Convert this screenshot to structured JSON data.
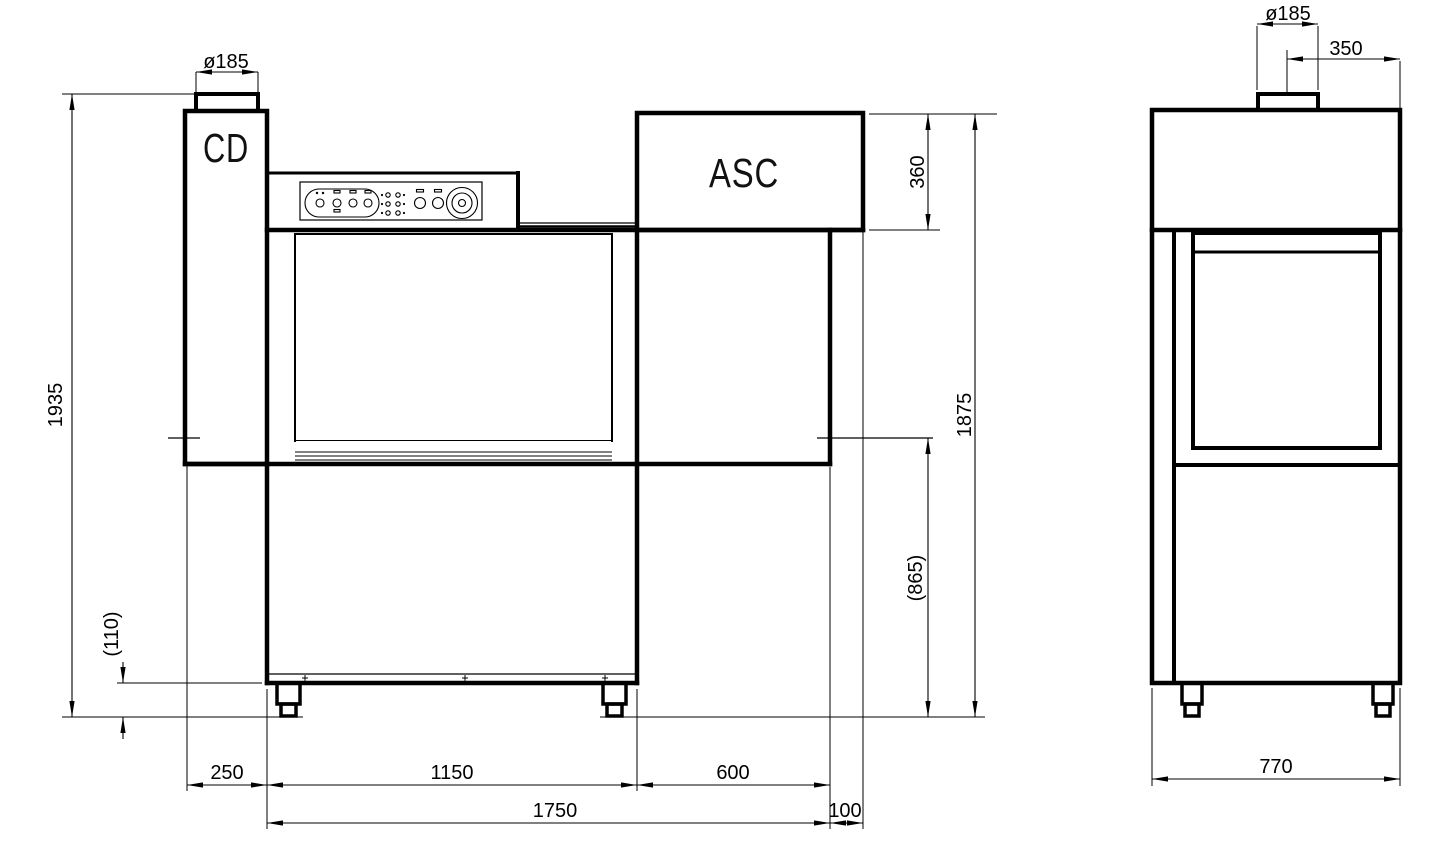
{
  "drawing": {
    "type": "technical-drawing",
    "units": {
      "cd_label": "CD",
      "asc_label": "ASC"
    },
    "front_view": {
      "dim_flue_diameter": "ø185",
      "dim_total_height": "1935",
      "dim_plinth_height": "(110)",
      "dim_hood_section_height": "360",
      "dim_machine_height": "1875",
      "dim_worktop_height": "(865)",
      "dim_left_module_width": "250",
      "dim_center_module_width": "1150",
      "dim_right_module_width": "600",
      "dim_overall_length": "1750",
      "dim_overhang": "100"
    },
    "side_view": {
      "dim_flue_diameter": "ø185",
      "dim_flue_offset": "350",
      "dim_depth": "770"
    }
  }
}
